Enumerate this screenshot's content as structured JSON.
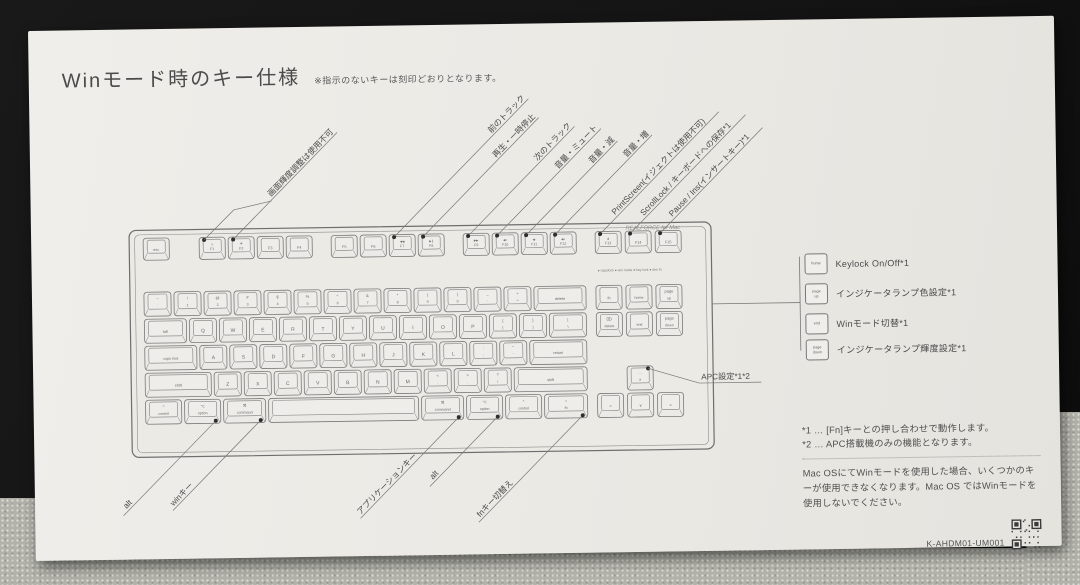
{
  "scene": {
    "mat_color": "#141414",
    "carpet_color": "#b2b2aa",
    "paper_color": "#ebe9e4",
    "ink": "#4a4a4a",
    "line": "#777777"
  },
  "title": {
    "text": "Winモード時のキー仕様",
    "note": "※指示のないキーは刻印どおりとなります。"
  },
  "keyboard": {
    "brand": "REALFORCE for Mac",
    "indicators": "● capslock   ● win mode   ● key lock   ● dim fn",
    "keys": [
      {
        "id": "esc",
        "x": 112,
        "y": 209,
        "w": 26,
        "h": 22,
        "t": "esc",
        "s": 3.8
      },
      {
        "id": "f1",
        "x": 168,
        "y": 209,
        "w": 26,
        "h": 22,
        "t": "☼",
        "b": "F1",
        "s": 4
      },
      {
        "id": "f2",
        "x": 197,
        "y": 209,
        "w": 26,
        "h": 22,
        "t": "☀",
        "b": "F2",
        "s": 4
      },
      {
        "id": "f3",
        "x": 226,
        "y": 209,
        "w": 26,
        "h": 22,
        "t": "F3",
        "s": 3.8
      },
      {
        "id": "f4",
        "x": 255,
        "y": 209,
        "w": 26,
        "h": 22,
        "t": "F4",
        "s": 3.8
      },
      {
        "id": "f5",
        "x": 300,
        "y": 209,
        "w": 26,
        "h": 22,
        "t": "F5",
        "s": 3.8
      },
      {
        "id": "f6",
        "x": 329,
        "y": 209,
        "w": 26,
        "h": 22,
        "t": "F6",
        "s": 3.8
      },
      {
        "id": "f7",
        "x": 358,
        "y": 209,
        "w": 26,
        "h": 22,
        "t": "◀◀",
        "b": "F7",
        "s": 3
      },
      {
        "id": "f8",
        "x": 387,
        "y": 209,
        "w": 26,
        "h": 22,
        "t": "▶∥",
        "b": "F8",
        "s": 3
      },
      {
        "id": "f9",
        "x": 432,
        "y": 209,
        "w": 26,
        "h": 22,
        "t": "▶▶",
        "b": "F9",
        "s": 3
      },
      {
        "id": "f10",
        "x": 461,
        "y": 209,
        "w": 26,
        "h": 22,
        "t": "◀×",
        "b": "F10",
        "s": 3
      },
      {
        "id": "f11",
        "x": 490,
        "y": 209,
        "w": 26,
        "h": 22,
        "t": "◀-",
        "b": "F11",
        "s": 3
      },
      {
        "id": "f12",
        "x": 519,
        "y": 209,
        "w": 26,
        "h": 22,
        "t": "◀+",
        "b": "F12",
        "s": 3
      },
      {
        "id": "f13",
        "x": 564,
        "y": 209,
        "w": 26,
        "h": 22,
        "t": "▲",
        "b": "F13",
        "s": 3.4
      },
      {
        "id": "f14",
        "x": 594,
        "y": 209,
        "w": 26,
        "h": 22,
        "t": "F14",
        "s": 3.8
      },
      {
        "id": "f15",
        "x": 624,
        "y": 209,
        "w": 26,
        "h": 22,
        "t": "F15",
        "s": 3.8
      },
      {
        "id": "grave",
        "x": 112,
        "y": 263,
        "w": 27,
        "h": 24,
        "t": "~",
        "b": "`"
      },
      {
        "id": "1",
        "x": 142,
        "y": 263,
        "w": 27,
        "h": 24,
        "t": "!",
        "b": "1"
      },
      {
        "id": "2",
        "x": 172,
        "y": 263,
        "w": 27,
        "h": 24,
        "t": "@",
        "b": "2"
      },
      {
        "id": "3",
        "x": 202,
        "y": 263,
        "w": 27,
        "h": 24,
        "t": "#",
        "b": "3"
      },
      {
        "id": "4",
        "x": 232,
        "y": 263,
        "w": 27,
        "h": 24,
        "t": "$",
        "b": "4"
      },
      {
        "id": "5",
        "x": 262,
        "y": 263,
        "w": 27,
        "h": 24,
        "t": "%",
        "b": "5"
      },
      {
        "id": "6",
        "x": 292,
        "y": 263,
        "w": 27,
        "h": 24,
        "t": "^",
        "b": "6"
      },
      {
        "id": "7",
        "x": 322,
        "y": 263,
        "w": 27,
        "h": 24,
        "t": "&",
        "b": "7"
      },
      {
        "id": "8",
        "x": 352,
        "y": 263,
        "w": 27,
        "h": 24,
        "t": "*",
        "b": "8"
      },
      {
        "id": "9",
        "x": 382,
        "y": 263,
        "w": 27,
        "h": 24,
        "t": "(",
        "b": "9"
      },
      {
        "id": "0",
        "x": 412,
        "y": 263,
        "w": 27,
        "h": 24,
        "t": ")",
        "b": "0"
      },
      {
        "id": "minus",
        "x": 442,
        "y": 263,
        "w": 27,
        "h": 24,
        "t": "_",
        "b": "-"
      },
      {
        "id": "equals",
        "x": 472,
        "y": 263,
        "w": 27,
        "h": 24,
        "t": "+",
        "b": "="
      },
      {
        "id": "delete",
        "x": 502,
        "y": 263,
        "w": 52,
        "h": 24,
        "t": "delete",
        "s": 3.8
      },
      {
        "id": "tab",
        "x": 112,
        "y": 290,
        "w": 42,
        "h": 24,
        "t": "tab",
        "s": 3.8
      },
      {
        "id": "q",
        "x": 157,
        "y": 290,
        "w": 27,
        "h": 24,
        "t": "Q",
        "s": 5
      },
      {
        "id": "w",
        "x": 187,
        "y": 290,
        "w": 27,
        "h": 24,
        "t": "W",
        "s": 5
      },
      {
        "id": "e",
        "x": 217,
        "y": 290,
        "w": 27,
        "h": 24,
        "t": "E",
        "s": 5
      },
      {
        "id": "r",
        "x": 247,
        "y": 290,
        "w": 27,
        "h": 24,
        "t": "R",
        "s": 5
      },
      {
        "id": "t",
        "x": 277,
        "y": 290,
        "w": 27,
        "h": 24,
        "t": "T",
        "s": 5
      },
      {
        "id": "y",
        "x": 307,
        "y": 290,
        "w": 27,
        "h": 24,
        "t": "Y",
        "s": 5
      },
      {
        "id": "u",
        "x": 337,
        "y": 290,
        "w": 27,
        "h": 24,
        "t": "U",
        "s": 5
      },
      {
        "id": "i",
        "x": 367,
        "y": 290,
        "w": 27,
        "h": 24,
        "t": "I",
        "s": 5
      },
      {
        "id": "o",
        "x": 397,
        "y": 290,
        "w": 27,
        "h": 24,
        "t": "O",
        "s": 5
      },
      {
        "id": "p",
        "x": 427,
        "y": 290,
        "w": 27,
        "h": 24,
        "t": "P",
        "s": 5
      },
      {
        "id": "lbracket",
        "x": 457,
        "y": 290,
        "w": 27,
        "h": 24,
        "t": "{",
        "b": "["
      },
      {
        "id": "rbracket",
        "x": 487,
        "y": 290,
        "w": 27,
        "h": 24,
        "t": "}",
        "b": "]"
      },
      {
        "id": "backslash",
        "x": 517,
        "y": 290,
        "w": 37,
        "h": 24,
        "t": "|",
        "b": "\\"
      },
      {
        "id": "capslock",
        "x": 112,
        "y": 317,
        "w": 52,
        "h": 24,
        "t": "caps lock",
        "s": 3.6
      },
      {
        "id": "a",
        "x": 167,
        "y": 317,
        "w": 27,
        "h": 24,
        "t": "A",
        "s": 5
      },
      {
        "id": "s",
        "x": 197,
        "y": 317,
        "w": 27,
        "h": 24,
        "t": "S",
        "s": 5
      },
      {
        "id": "d",
        "x": 227,
        "y": 317,
        "w": 27,
        "h": 24,
        "t": "D",
        "s": 5
      },
      {
        "id": "f",
        "x": 257,
        "y": 317,
        "w": 27,
        "h": 24,
        "t": "F",
        "s": 5
      },
      {
        "id": "g",
        "x": 287,
        "y": 317,
        "w": 27,
        "h": 24,
        "t": "G",
        "s": 5
      },
      {
        "id": "h",
        "x": 317,
        "y": 317,
        "w": 27,
        "h": 24,
        "t": "H",
        "s": 5
      },
      {
        "id": "j",
        "x": 347,
        "y": 317,
        "w": 27,
        "h": 24,
        "t": "J",
        "s": 5
      },
      {
        "id": "k",
        "x": 377,
        "y": 317,
        "w": 27,
        "h": 24,
        "t": "K",
        "s": 5
      },
      {
        "id": "l",
        "x": 407,
        "y": 317,
        "w": 27,
        "h": 24,
        "t": "L",
        "s": 5
      },
      {
        "id": "semicolon",
        "x": 437,
        "y": 317,
        "w": 27,
        "h": 24,
        "t": ":",
        "b": ";"
      },
      {
        "id": "quote",
        "x": 467,
        "y": 317,
        "w": 27,
        "h": 24,
        "t": "\"",
        "b": "'"
      },
      {
        "id": "return",
        "x": 497,
        "y": 317,
        "w": 57,
        "h": 24,
        "t": "return",
        "s": 3.8
      },
      {
        "id": "lshift",
        "x": 112,
        "y": 344,
        "w": 66,
        "h": 24,
        "t": "shift",
        "s": 3.8
      },
      {
        "id": "z",
        "x": 181,
        "y": 344,
        "w": 27,
        "h": 24,
        "t": "Z",
        "s": 5
      },
      {
        "id": "x",
        "x": 211,
        "y": 344,
        "w": 27,
        "h": 24,
        "t": "X",
        "s": 5
      },
      {
        "id": "c",
        "x": 241,
        "y": 344,
        "w": 27,
        "h": 24,
        "t": "C",
        "s": 5
      },
      {
        "id": "v",
        "x": 271,
        "y": 344,
        "w": 27,
        "h": 24,
        "t": "V",
        "s": 5
      },
      {
        "id": "b",
        "x": 301,
        "y": 344,
        "w": 27,
        "h": 24,
        "t": "B",
        "s": 5
      },
      {
        "id": "n",
        "x": 331,
        "y": 344,
        "w": 27,
        "h": 24,
        "t": "N",
        "s": 5
      },
      {
        "id": "m",
        "x": 361,
        "y": 344,
        "w": 27,
        "h": 24,
        "t": "M",
        "s": 5
      },
      {
        "id": "comma",
        "x": 391,
        "y": 344,
        "w": 27,
        "h": 24,
        "t": "<",
        "b": ","
      },
      {
        "id": "period",
        "x": 421,
        "y": 344,
        "w": 27,
        "h": 24,
        "t": ">",
        "b": "."
      },
      {
        "id": "slash",
        "x": 451,
        "y": 344,
        "w": 27,
        "h": 24,
        "t": "?",
        "b": "/"
      },
      {
        "id": "rshift",
        "x": 481,
        "y": 344,
        "w": 73,
        "h": 24,
        "t": "shift",
        "s": 3.8
      },
      {
        "id": "lcontrol",
        "x": 112,
        "y": 371,
        "w": 36,
        "h": 24,
        "t": "^",
        "b": "control"
      },
      {
        "id": "loption",
        "x": 151,
        "y": 371,
        "w": 36,
        "h": 24,
        "t": "⌥",
        "b": "option"
      },
      {
        "id": "lcommand",
        "x": 190,
        "y": 371,
        "w": 42,
        "h": 24,
        "t": "⌘",
        "b": "command"
      },
      {
        "id": "space",
        "x": 235,
        "y": 371,
        "w": 150,
        "h": 24
      },
      {
        "id": "rcommand",
        "x": 388,
        "y": 371,
        "w": 42,
        "h": 24,
        "t": "⌘",
        "b": "command"
      },
      {
        "id": "roption",
        "x": 433,
        "y": 371,
        "w": 36,
        "h": 24,
        "t": "⌥",
        "b": "option"
      },
      {
        "id": "rcontrol",
        "x": 472,
        "y": 371,
        "w": 36,
        "h": 24,
        "t": "^",
        "b": "control"
      },
      {
        "id": "fn",
        "x": 511,
        "y": 371,
        "w": 43,
        "h": 24,
        "t": "○",
        "b": "fn"
      },
      {
        "id": "nav-fn",
        "x": 564,
        "y": 263,
        "w": 26,
        "h": 24,
        "t": "fn",
        "s": 3.8
      },
      {
        "id": "home",
        "x": 594,
        "y": 263,
        "w": 26,
        "h": 24,
        "t": "home",
        "s": 3.6
      },
      {
        "id": "page-up",
        "x": 624,
        "y": 263,
        "w": 26,
        "h": 24,
        "t": "page",
        "b": "up"
      },
      {
        "id": "fwd-delete",
        "x": 564,
        "y": 290,
        "w": 26,
        "h": 24,
        "t": "⌦",
        "b": "delete"
      },
      {
        "id": "end",
        "x": 594,
        "y": 290,
        "w": 26,
        "h": 24,
        "t": "end",
        "s": 3.6
      },
      {
        "id": "page-down",
        "x": 624,
        "y": 290,
        "w": 26,
        "h": 24,
        "t": "page",
        "b": "down"
      },
      {
        "id": "arrow-up",
        "x": 594,
        "y": 344,
        "w": 26,
        "h": 24,
        "t": "- - -",
        "b": "∧",
        "s": 3
      },
      {
        "id": "arrow-left",
        "x": 564,
        "y": 371,
        "w": 26,
        "h": 24,
        "t": "<",
        "s": 4
      },
      {
        "id": "arrow-down",
        "x": 594,
        "y": 371,
        "w": 26,
        "h": 24,
        "t": "∨",
        "s": 4
      },
      {
        "id": "arrow-right",
        "x": 624,
        "y": 371,
        "w": 26,
        "h": 24,
        "t": ">",
        "s": 4
      }
    ]
  },
  "callouts": {
    "top": [
      {
        "label": "画面輝度調整は使用不可",
        "x": 202,
        "y": 211.5,
        "lead": 55,
        "branch": [
          [
            173,
            211.5
          ],
          [
            203,
            182
          ],
          [
            241,
            173.5
          ]
        ]
      },
      {
        "label": "前のトラック",
        "x": 363,
        "y": 211.5,
        "lead": 140
      },
      {
        "label": "再生・一時停止",
        "x": 392,
        "y": 211.5,
        "lead": 105
      },
      {
        "label": "次のトラック",
        "x": 437,
        "y": 211.5,
        "lead": 100
      },
      {
        "label": "音量・ミュート",
        "x": 466,
        "y": 211.5,
        "lead": 88
      },
      {
        "label": "音量・減",
        "x": 495,
        "y": 211.5,
        "lead": 95
      },
      {
        "label": "音量・増",
        "x": 524,
        "y": 211.5,
        "lead": 103
      },
      {
        "label": "PrintScreen(イジェクトは使用不可)",
        "x": 569,
        "y": 211.5,
        "lead": 22
      },
      {
        "label": "ScrollLock / キーボードへの保存*1",
        "x": 599,
        "y": 211.5,
        "lead": 20
      },
      {
        "label": "Pause / Ins(インサートキー)*1",
        "x": 629,
        "y": 211.5,
        "lead": 18
      }
    ],
    "bottom": [
      {
        "label": "alt",
        "x": 182,
        "y": 392.5,
        "lead": 115
      },
      {
        "label": "winキー",
        "x": 227,
        "y": 392.5,
        "lead": 92
      },
      {
        "label": "アプリケーションキー",
        "x": 425,
        "y": 392.5,
        "lead": 55
      },
      {
        "label": "alt",
        "x": 464,
        "y": 392.5,
        "lead": 80
      },
      {
        "label": "fnキー切替え",
        "x": 549,
        "y": 392.5,
        "lead": 95
      }
    ],
    "apc": {
      "label": "APC設定*1*2",
      "dot": [
        615,
        346.5
      ],
      "elbow": [
        666,
        362
      ],
      "underline_to": 728,
      "text": [
        668,
        358.5
      ]
    },
    "bracket": [
      [
        680,
        283,
        768,
        283
      ],
      [
        768,
        237,
        768,
        331
      ]
    ]
  },
  "right_panel": {
    "items": [
      {
        "key": "home",
        "label": "Keylock On/Off*1"
      },
      {
        "key": "page\nup",
        "label": "インジケータランプ色設定*1"
      },
      {
        "key": "end",
        "label": "Winモード切替*1"
      },
      {
        "key": "page\ndown",
        "label": "インジケータランプ輝度設定*1"
      }
    ]
  },
  "footnotes": {
    "line1": "*1 … [Fn]キーとの押し合わせで動作します。",
    "line2": "*2 … APC搭載機のみの機能となります。",
    "paragraph": "Mac OSにてWinモードを使用した場合、いくつかのキーが使用できなくなります。Mac OS ではWinモードを使用しないでください。",
    "model": "K-AHDM01-UM001"
  }
}
